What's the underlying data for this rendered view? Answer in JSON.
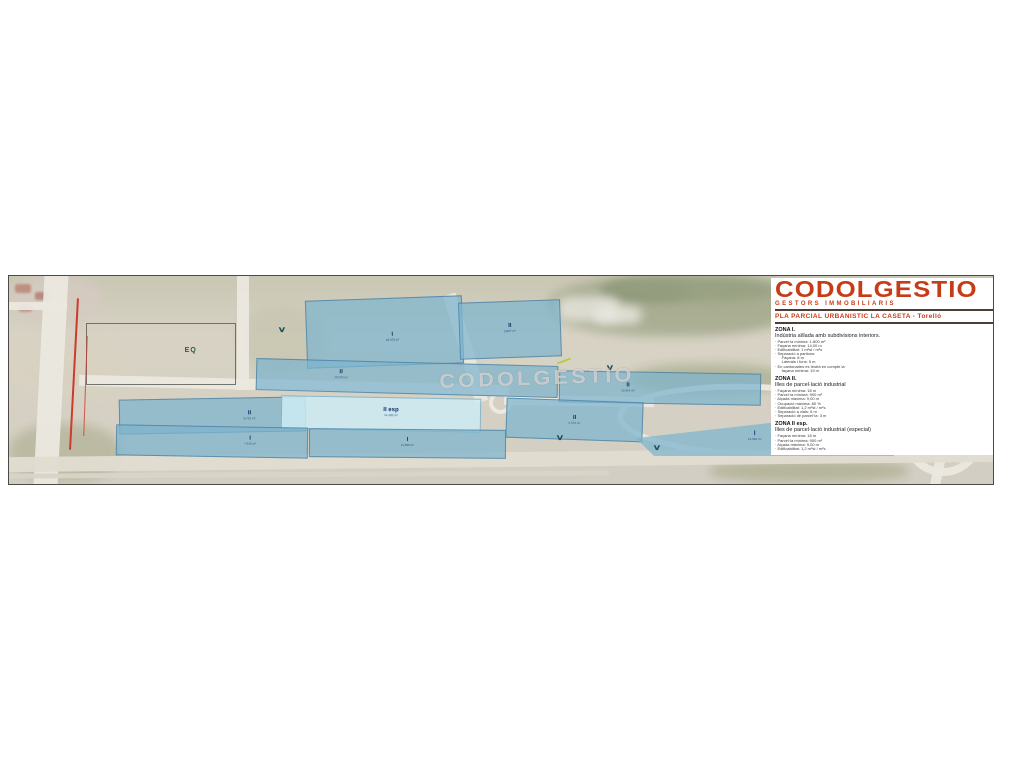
{
  "legend": {
    "logo": "CODOLGESTIO",
    "logo_sub": "GESTORS IMMOBILIARIS",
    "subtitle": "PLA PARCIAL URBANISTIC LA CASETA - Torelló",
    "brand_color": "#c63c16",
    "sections": [
      {
        "heading": "ZONA I.",
        "description": "Indústria aïllada amb subdivisions interiors.",
        "items": [
          "· Parcel·la mínima: 1.800 m²",
          "· Façana mínima: 14,00 m",
          "· Edificabilitat: 1 m²st / m²s",
          "· Separació a partions:",
          "      Façana: 8 m",
          "      Laterals i fons: 5 m",
          "· En cantonades es tindrà en compte la",
          "      façana mínima: 19 m"
        ]
      },
      {
        "heading": "ZONA II.",
        "description": "Illes de parcel·lació industrial",
        "items": [
          "· Façana mínima: 18 m",
          "· Parcel·la mínima: 900 m²",
          "· Alçada màxima: 9,00 m",
          "· Ocupació màxima: 80 %",
          "· Edificabilitat: 1,2 m²st / m²s",
          "· Separació a vials: 5 m",
          "· Separació de parcel·la: 3 m"
        ]
      },
      {
        "heading": "ZONA II esp.",
        "description": "Illes de parcel·lació industrial (especial)",
        "items": [
          "· Façana mínima: 18 m",
          "· Parcel·la mínima: 900 m²",
          "· Alçada màxima: 9,00 m",
          "· Edificabilitat: 1,2 m²st / m²s"
        ]
      }
    ]
  },
  "map": {
    "watermark": "CODOLGESTIO",
    "eq_label": "EQ",
    "colors": {
      "parcel_blue": "#7db4c9",
      "parcel_light": "#cdeaf3",
      "zone_label": "#14366b",
      "redline": "#cc3b2c",
      "road": "#ebe8df"
    },
    "parcels": [
      {
        "zone": "I",
        "area": "18.073 m²",
        "x": 297,
        "y": 22,
        "w": 155,
        "h": 66,
        "rot": -2,
        "lx": 55,
        "ly": 58,
        "variant": "blue"
      },
      {
        "zone": "II",
        "area": "9.827 m²",
        "x": 450,
        "y": 25,
        "w": 100,
        "h": 55,
        "rot": -2,
        "lx": 50,
        "ly": 48,
        "variant": "blue"
      },
      {
        "zone": "II",
        "area": "10.203 m²",
        "x": 247,
        "y": 86,
        "w": 300,
        "h": 30,
        "rot": 1.5,
        "lx": 28,
        "ly": 42,
        "variant": "blue"
      },
      {
        "zone": "II",
        "area": "12.654 m²",
        "x": 550,
        "y": 96,
        "w": 200,
        "h": 30,
        "rot": 1,
        "lx": 34,
        "ly": 50,
        "variant": "blue"
      },
      {
        "zone": "II",
        "area": "8.751 m²",
        "x": 110,
        "y": 122,
        "w": 185,
        "h": 33,
        "rot": -1,
        "lx": 70,
        "ly": 50,
        "variant": "blue"
      },
      {
        "zone": "II esp",
        "area": "14.420 m²",
        "x": 272,
        "y": 121,
        "w": 198,
        "h": 32,
        "rot": 1,
        "lx": 55,
        "ly": 45,
        "variant": "light"
      },
      {
        "zone": "I",
        "area": "7.942 m²",
        "x": 107,
        "y": 150,
        "w": 190,
        "h": 29,
        "rot": 1,
        "lx": 70,
        "ly": 45,
        "variant": "blue"
      },
      {
        "zone": "I",
        "area": "11.028 m²",
        "x": 300,
        "y": 153,
        "w": 195,
        "h": 27,
        "rot": 0.5,
        "lx": 50,
        "ly": 45,
        "variant": "blue"
      },
      {
        "zone": "II",
        "area": "6.874 m²",
        "x": 497,
        "y": 124,
        "w": 135,
        "h": 38,
        "rot": 2,
        "lx": 50,
        "ly": 50,
        "variant": "blue"
      },
      {
        "zone": "I",
        "area": "21.540 m²",
        "x": 627,
        "y": 133,
        "w": 258,
        "h": 47,
        "rot": 0,
        "lx": 46,
        "ly": 58,
        "variant": "blue",
        "taper": true
      }
    ],
    "chevrons": [
      {
        "x": 270,
        "y": 50
      },
      {
        "x": 598,
        "y": 88
      },
      {
        "x": 548,
        "y": 158
      },
      {
        "x": 645,
        "y": 168
      }
    ],
    "chevron_glyph": "∨"
  }
}
